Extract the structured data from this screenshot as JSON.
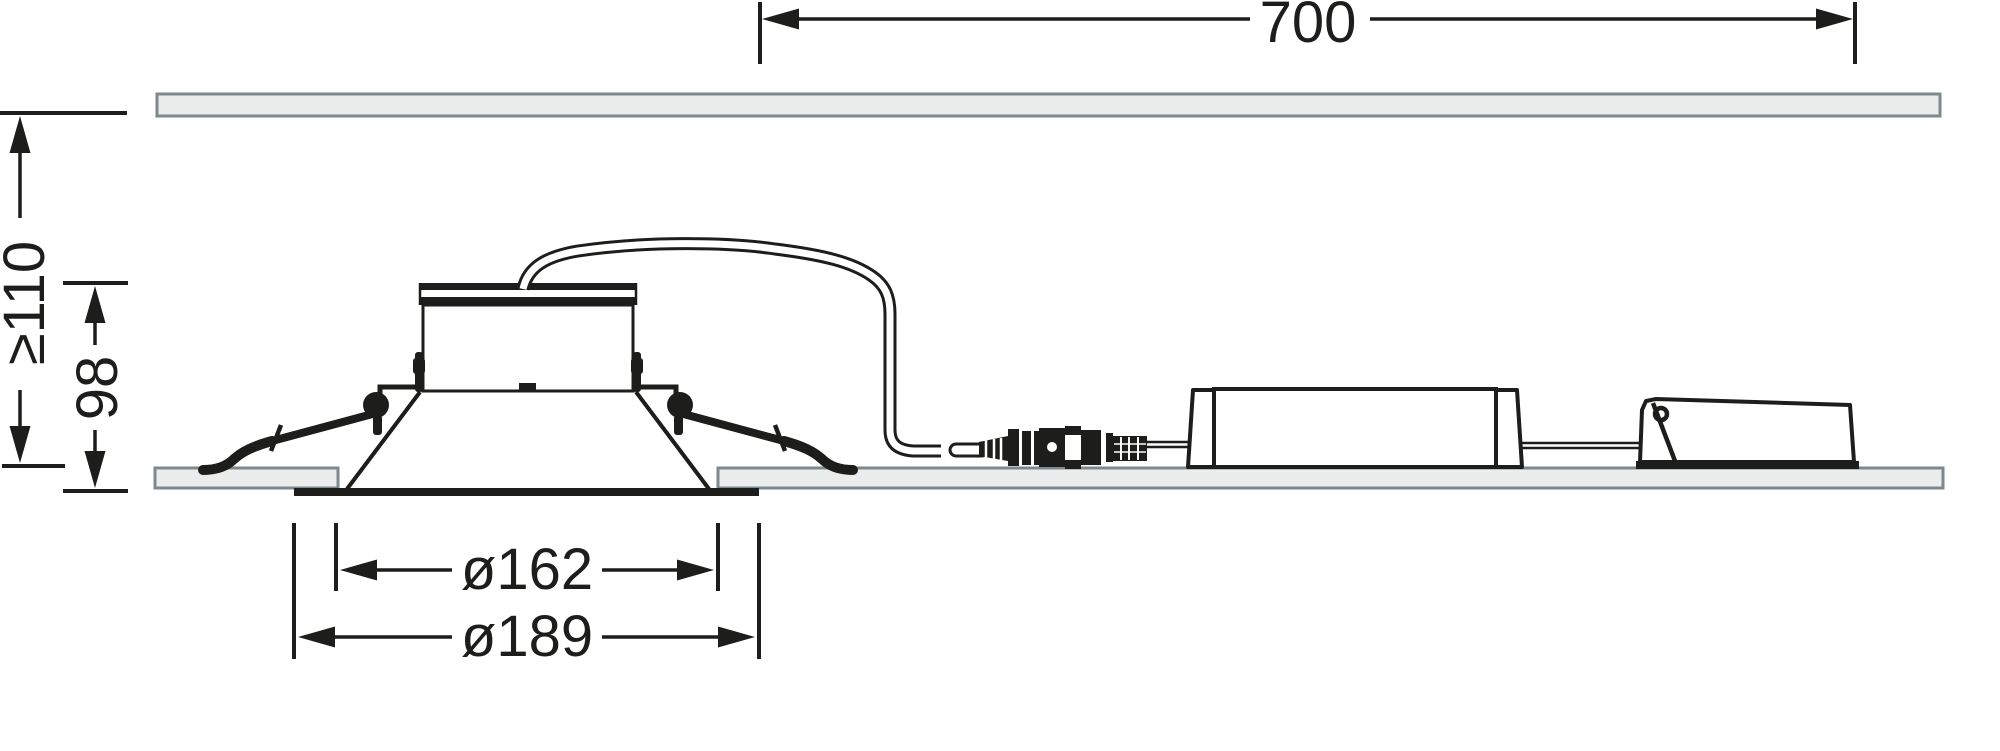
{
  "diagram": {
    "kind": "technical-dimension-drawing",
    "subject": "recessed-downlight-ceiling-installation-side-view"
  },
  "dimensions": {
    "driver_clearance_length": "700",
    "min_ceiling_void_depth": "≥110",
    "recessed_height": "98",
    "cutout_diameter": "ø162",
    "trim_diameter": "ø189"
  },
  "colors": {
    "line": "#1d1d1b",
    "panel_fill": "#ebedec",
    "panel_border": "#7d898e",
    "bg": "#ffffff"
  }
}
